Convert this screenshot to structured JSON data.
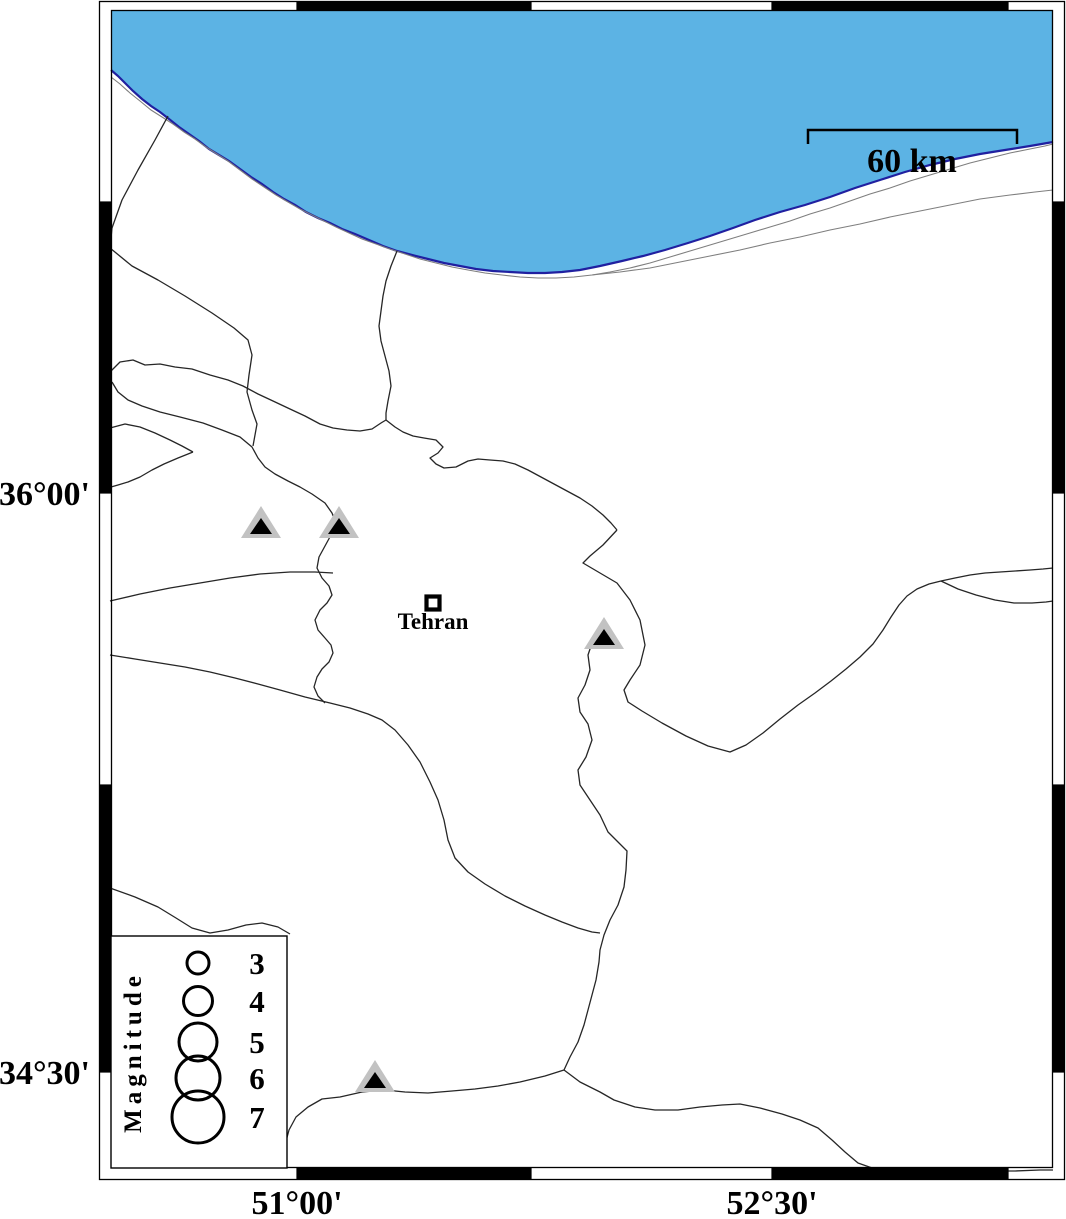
{
  "map": {
    "region_name": "Tehran region seismicity map",
    "sea_name": "caspian-sea",
    "colors": {
      "sea_fill": "#5cb3e4",
      "sea_edge": "#2020a0",
      "land_fill": "#ffffff",
      "boundary_line": "#262626",
      "secondary_line": "#7e7e7e",
      "frame_black": "#000000",
      "volcano_gray": "#c2c2c2",
      "volcano_black": "#000000"
    }
  },
  "axes": {
    "left_ticks": [
      {
        "label": "36°00'",
        "y": 493
      },
      {
        "label": "34°30'",
        "y": 1072
      }
    ],
    "bottom_ticks": [
      {
        "label": "51°00'",
        "x": 297
      },
      {
        "label": "52°30'",
        "x": 772
      }
    ]
  },
  "frame": {
    "black_segments_horizontal": [
      [
        297,
        531
      ],
      [
        772,
        1008
      ]
    ],
    "black_segments_vertical": [
      [
        202,
        493
      ],
      [
        785,
        1072
      ]
    ]
  },
  "scale_bar": {
    "label": "60 km",
    "x1": 808,
    "x2": 1017,
    "y": 130
  },
  "city": {
    "name": "Tehran",
    "x": 433,
    "y": 603
  },
  "volcanoes": [
    {
      "x": 261,
      "y": 538
    },
    {
      "x": 339,
      "y": 538
    },
    {
      "x": 604,
      "y": 649
    },
    {
      "x": 375,
      "y": 1092
    }
  ],
  "legend": {
    "title": "Magnitude",
    "circle_cx": 198,
    "label_x": 257,
    "items": [
      {
        "label": "3",
        "cy": 963,
        "radius": 11
      },
      {
        "label": "4",
        "cy": 1001,
        "radius": 14.5
      },
      {
        "label": "5",
        "cy": 1042,
        "radius": 19
      },
      {
        "label": "6",
        "cy": 1078,
        "radius": 22
      },
      {
        "label": "7",
        "cy": 1117,
        "radius": 26
      }
    ]
  }
}
